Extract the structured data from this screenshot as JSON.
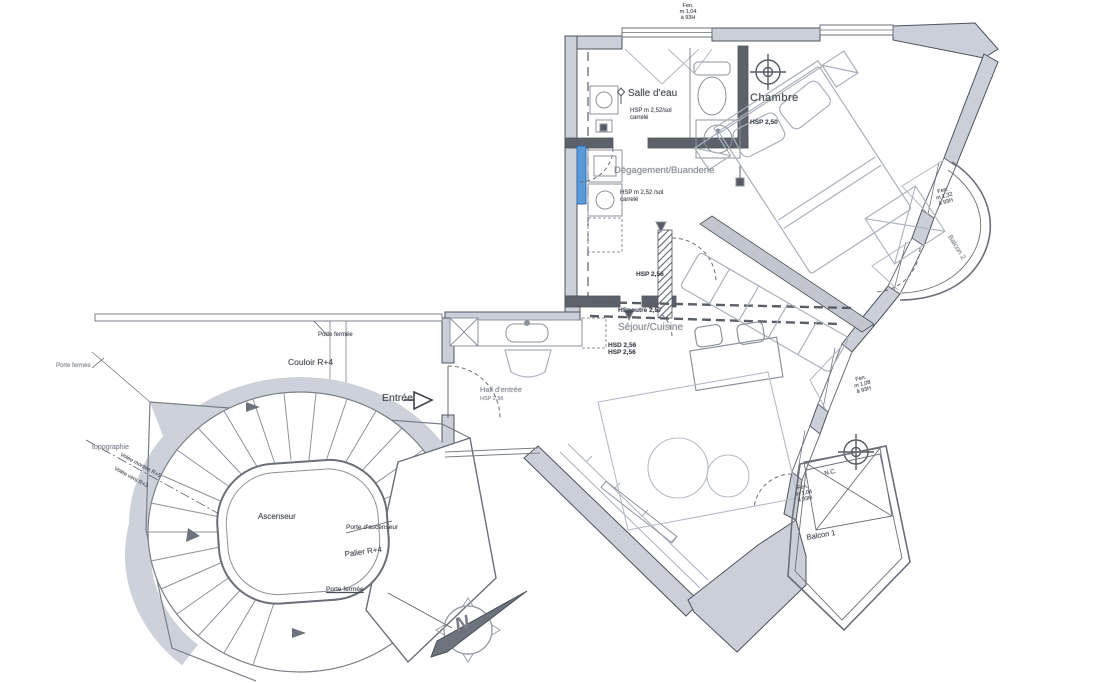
{
  "page": {
    "background": "#ffffff"
  },
  "colors": {
    "wall_fill": "#cbd0d8",
    "wall_stroke": "#4e535b",
    "thin_line": "#8d939b",
    "furniture_line": "#aab1bb",
    "highlight_blue": "#5b9bd5",
    "compass_gray": "#6d737c"
  },
  "rooms": {
    "salle_deau": {
      "name": "Salle d'eau",
      "hsp": "HSP m 2,52/sol",
      "floor": "carrelé"
    },
    "degagement": {
      "name": "Dégagement/Buanderie",
      "hsp": "HSP m 2,52 /sol",
      "floor": "carrelé"
    },
    "chambre": {
      "name": "Chambre",
      "hsp": "HSP 2,50"
    },
    "sejour": {
      "name": "Séjour/Cuisine",
      "hsd": "HSD 2,56",
      "hsp": "HSP 2,56",
      "hsp_mid": "HSP 2,56",
      "beam": "HSpoutre 2,57"
    },
    "hall": {
      "name": "Hall d'entrée",
      "hsp": "HSP 2,56"
    },
    "couloir": {
      "name": "Couloir R+4"
    },
    "palier": {
      "name": "Palier R+4"
    },
    "ascenseur": {
      "name": "Ascenseur"
    },
    "balcon1": {
      "name": "Balcon 1"
    },
    "balcon2": {
      "name": "Balcon 2"
    },
    "nc": {
      "name": "N.C."
    }
  },
  "annotations": {
    "entree": "Entrée",
    "porte_fermee_couloir": "Porte fermée",
    "porte_fermee_left": "Porte fermée",
    "porte_ascenseur": "Porte d'ascenseur",
    "porte_fermee_palier": "Porte fermée",
    "topographie": "topographie",
    "volee_up": "Volée montée R+5",
    "volee_down": "Volée vers R+3",
    "north": "N"
  },
  "windows": {
    "top": {
      "l1": "Fen.",
      "l2": "m 1,04",
      "l3": "à 93H"
    },
    "right": {
      "l1": "Fen.",
      "l2": "m 1,32",
      "l3": "à 93H"
    },
    "right_low": {
      "l1": "Fen.",
      "l2": "m 1,08",
      "l3": "à 93H"
    },
    "balcon1": {
      "l1": "Fen.",
      "l2": "m 1,04",
      "l3": "à 93H"
    }
  }
}
